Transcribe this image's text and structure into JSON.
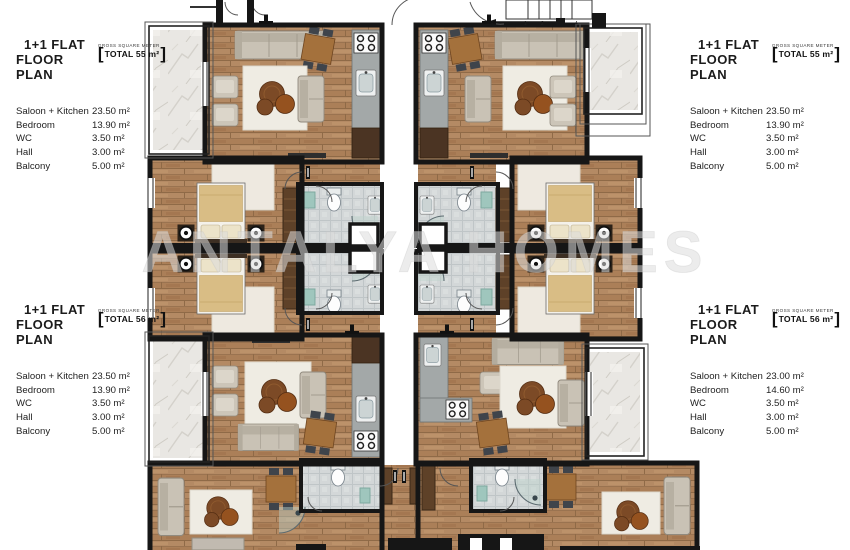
{
  "watermark": "ANTALYA HOMES",
  "plan": {
    "stair_numbers": "1 2 3 4 5",
    "colors": {
      "wood_floor": "#b48a64",
      "marble_balcony": "#e9e7e3",
      "bathroom_tile": "#d3d7d8",
      "wall": "#161616",
      "bed_linen": "#d9bd85",
      "bath_mat_teal": "#9fc6bd",
      "watermark_gray": "#dcdcdc"
    }
  },
  "spec_blocks": {
    "top_left": {
      "title_line1": "1+1 FLAT",
      "title_line2": "FLOOR PLAN",
      "gross_label": "GROSS SQUARE METER",
      "bracket_open": "[",
      "bracket_close": "]",
      "total": "TOTAL 55 m²",
      "rooms": [
        {
          "label": "Saloon + Kitchen",
          "value": "23.50 m²"
        },
        {
          "label": "Bedroom",
          "value": "13.90 m²"
        },
        {
          "label": "WC",
          "value": "3.50 m²"
        },
        {
          "label": "Hall",
          "value": "3.00 m²"
        },
        {
          "label": "Balcony",
          "value": "5.00 m²"
        }
      ]
    },
    "top_right": {
      "title_line1": "1+1 FLAT",
      "title_line2": "FLOOR PLAN",
      "gross_label": "GROSS SQUARE METER",
      "bracket_open": "[",
      "bracket_close": "]",
      "total": "TOTAL 55 m²",
      "rooms": [
        {
          "label": "Saloon + Kitchen",
          "value": "23.50 m²"
        },
        {
          "label": "Bedroom",
          "value": "13.90 m²"
        },
        {
          "label": "WC",
          "value": "3.50 m²"
        },
        {
          "label": "Hall",
          "value": "3.00 m²"
        },
        {
          "label": "Balcony",
          "value": "5.00 m²"
        }
      ]
    },
    "bottom_left": {
      "title_line1": "1+1 FLAT",
      "title_line2": "FLOOR PLAN",
      "gross_label": "GROSS SQUARE METER",
      "bracket_open": "[",
      "bracket_close": "]",
      "total": "TOTAL 56 m²",
      "rooms": [
        {
          "label": "Saloon + Kitchen",
          "value": "23.50 m²"
        },
        {
          "label": "Bedroom",
          "value": "13.90 m²"
        },
        {
          "label": "WC",
          "value": "3.50 m²"
        },
        {
          "label": "Hall",
          "value": "3.00 m²"
        },
        {
          "label": "Balcony",
          "value": "5.00 m²"
        }
      ]
    },
    "bottom_right": {
      "title_line1": "1+1 FLAT",
      "title_line2": "FLOOR PLAN",
      "gross_label": "GROSS SQUARE METER",
      "bracket_open": "[",
      "bracket_close": "]",
      "total": "TOTAL 56 m²",
      "rooms": [
        {
          "label": "Saloon + Kitchen",
          "value": "23.00 m²"
        },
        {
          "label": "Bedroom",
          "value": "14.60 m²"
        },
        {
          "label": "WC",
          "value": "3.50 m²"
        },
        {
          "label": "Hall",
          "value": "3.00 m²"
        },
        {
          "label": "Balcony",
          "value": "5.00 m²"
        }
      ]
    }
  }
}
